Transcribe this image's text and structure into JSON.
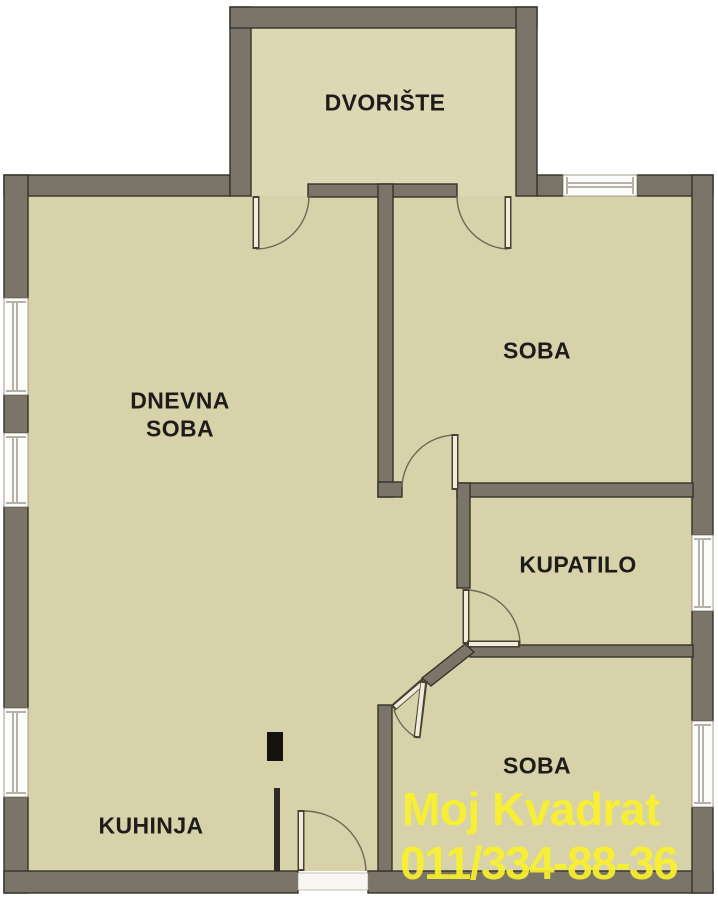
{
  "rooms": {
    "dvoriste": {
      "label": "DVORIŠTE"
    },
    "dnevna_soba": {
      "line1": "DNEVNA",
      "line2": "SOBA"
    },
    "soba_top": {
      "label": "SOBA"
    },
    "kupatilo": {
      "label": "KUPATILO"
    },
    "soba_bottom": {
      "label": "SOBA"
    },
    "kuhinja": {
      "label": "KUHINJA"
    }
  },
  "watermark": {
    "company": "Moj Kvadrat",
    "phone": "011/334-88-36",
    "color": "#f8f12b"
  },
  "colors": {
    "background": "#ffffff",
    "floor": "#d7d2a9",
    "courtyard_floor": "#ddd8b4",
    "wall": "#7b7468",
    "wall_outline": "#36322b",
    "door_line": "#6f6855",
    "window_fill": "#fcfcfa",
    "label_text": "#1e1c1a",
    "flue": "#151310"
  }
}
